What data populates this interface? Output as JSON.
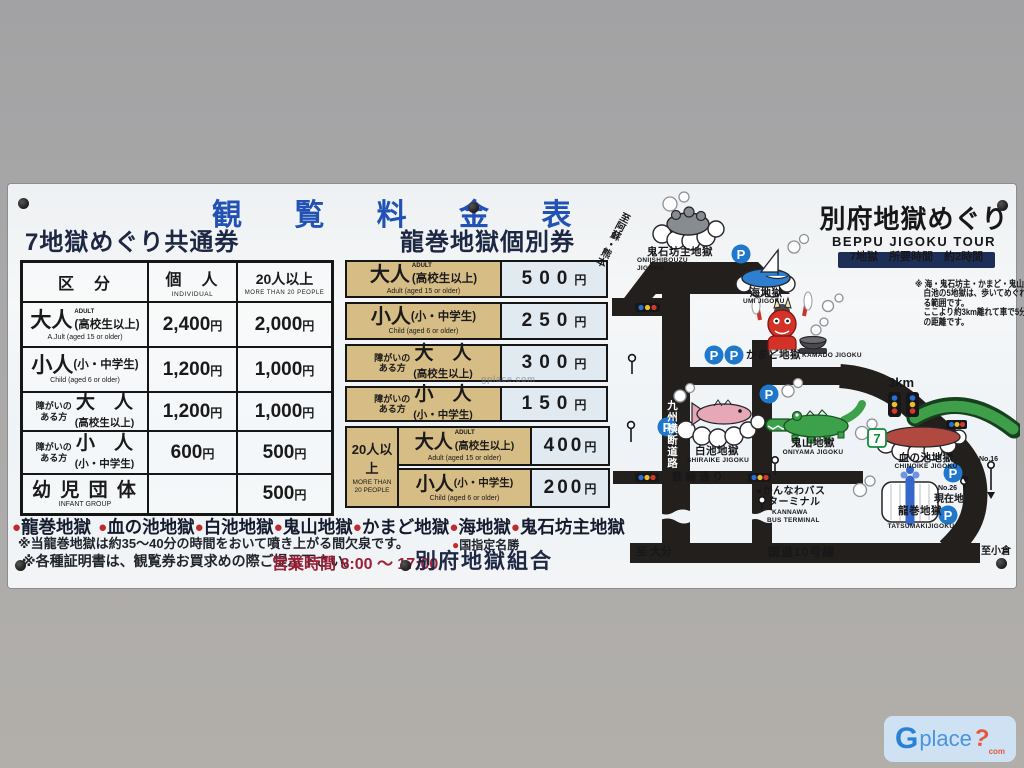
{
  "colors": {
    "title_blue": "#2152b4",
    "heading_navy": "#1d2844",
    "accent_red": "#c0272d",
    "hours_red": "#9c1f35",
    "tan_cell": "#d6bc85",
    "price_cell": "#e2eaf1",
    "road_black": "#221f1c",
    "parking_blue": "#1f78cc",
    "signal_blue": "#2b6fd4",
    "signal_yellow": "#e8c12a",
    "signal_red": "#d43a2a",
    "bridge_green": "#3f9e4a"
  },
  "sign": {
    "title": "観 覧 料 金 表",
    "bullet": "●",
    "units": {
      "yen": "円"
    },
    "left": {
      "heading": "7地獄めぐり共通券",
      "header": {
        "category": "区　分",
        "individual": "個　人",
        "individual_en": "INDIVIDUAL",
        "group": "20人以上",
        "group_en": "MORE THAN 20 PEOPLE"
      },
      "rows": [
        {
          "big": "大人",
          "sup": "ADULT",
          "paren": "(高校生以上)",
          "sub": "A.Jult (aged 15 or older)",
          "individual": "2,400",
          "group": "2,000"
        },
        {
          "big": "小人",
          "paren": "(小・中学生)",
          "sub": "Child (aged 6 or older)",
          "individual": "1,200",
          "group": "1,000"
        },
        {
          "prefix1": "障がいの",
          "prefix2": "ある方",
          "big": "大　人",
          "paren": "(高校生以上)",
          "individual": "1,200",
          "group": "1,000"
        },
        {
          "prefix1": "障がいの",
          "prefix2": "ある方",
          "big": "小　人",
          "paren": "(小・中学生)",
          "individual": "600",
          "group": "500"
        },
        {
          "big": "幼 児 団 体",
          "sub": "INFANT  GROUP",
          "group": "500"
        }
      ]
    },
    "middle": {
      "heading": "龍巻地獄個別券",
      "rows": [
        {
          "big": "大人",
          "sup": "ADULT",
          "paren": "(高校生以上)",
          "sub": "Adult (aged 15 or older)",
          "price": "500"
        },
        {
          "big": "小人",
          "paren": "(小・中学生)",
          "sub": "Child (aged 6 or older)",
          "price": "250"
        },
        {
          "prefix1": "障がいの",
          "prefix2": "ある方",
          "big": "大　人",
          "paren": "(高校生以上)",
          "price": "300"
        },
        {
          "prefix1": "障がいの",
          "prefix2": "ある方",
          "big": "小　人",
          "paren": "(小・中学生)",
          "price": "150"
        }
      ],
      "group": {
        "label": "20人以上",
        "label_en1": "MORE THAN",
        "label_en2": "20 PEOPLE",
        "rows": [
          {
            "big": "大人",
            "sup": "ADULT",
            "paren": "(高校生以上)",
            "sub": "Adult (aged 15 or older)",
            "price": "400"
          },
          {
            "big": "小人",
            "paren": "(小・中学生)",
            "sub": "Child (aged 6 or older)",
            "price": "200"
          }
        ]
      }
    },
    "hells": [
      "龍巻地獄",
      "血の池地獄",
      "白池地獄",
      "鬼山地獄",
      "かまど地獄",
      "海地獄",
      "鬼石坊主地獄"
    ],
    "notes": {
      "geyser_note": "※当龍巻地獄は約35〜40分の時間をおいて噴き上がる間欠泉です。",
      "designation": "国指定名勝",
      "certificate_note": "※各種証明書は、観覧券お買求めの際ご提示下さい。",
      "hours_label": "営業時間",
      "hours": "8:00 〜 17:00",
      "association": "別府地獄組合"
    }
  },
  "map": {
    "title": "別府地獄めぐり",
    "subtitle": "BEPPU  JIGOKU  TOUR",
    "badge": "7地獄　所要時間　約2時間",
    "note_lines": {
      "l1": "※ 海・鬼石坊主・かまど・鬼山・",
      "l2": "白池の5地獄は、歩いてめぐれ",
      "l3": "る範囲です。",
      "l4": "ここより約3km離れて車で5分",
      "l5": "の距離です。"
    },
    "locations": {
      "onishibouzu": {
        "name": "鬼石坊主地獄",
        "en1": "ONIISHIBOUZU",
        "en2": "JIGOKU"
      },
      "umi": {
        "name": "海地獄",
        "en": "UMI JIGOKU"
      },
      "kamado": {
        "name": "かまど地獄",
        "en": "KAMADO JIGOKU"
      },
      "shiraike": {
        "name": "白池地獄",
        "en": "SHIRAIKE JIGOKU"
      },
      "oniyama": {
        "name": "鬼山地獄",
        "en": "ONIYAMA JIGOKU"
      },
      "chinoike": {
        "name": "血の池地獄",
        "en": "CHINOIKE JIGOKU"
      },
      "tatsumaki": {
        "name": "龍巻地獄",
        "en": "TATSUMAKIJIGOKU"
      },
      "kannawa1": "●かんなわバス",
      "kannawa2": "ターミナル",
      "kannawa_en1": "KANNAWA",
      "kannawa_en2": "BUS  TERMINAL"
    },
    "roads": {
      "kyushu": "九州横断道路",
      "kannawa_st": "鉄輪通り",
      "route10": "国道10号線",
      "to_oita": "至 大分",
      "to_kokura": "至小倉",
      "to_aso": "至阿蘇・熊本"
    },
    "labels": {
      "km": "3km",
      "current": "現在地",
      "no26": "No.26",
      "no16": "No.16",
      "p": "P",
      "seven": "7"
    }
  },
  "watermark": {
    "small": "gplace.com",
    "logo_g": "G",
    "logo_place": "place",
    "logo_q": "?",
    "logo_com": "com"
  }
}
